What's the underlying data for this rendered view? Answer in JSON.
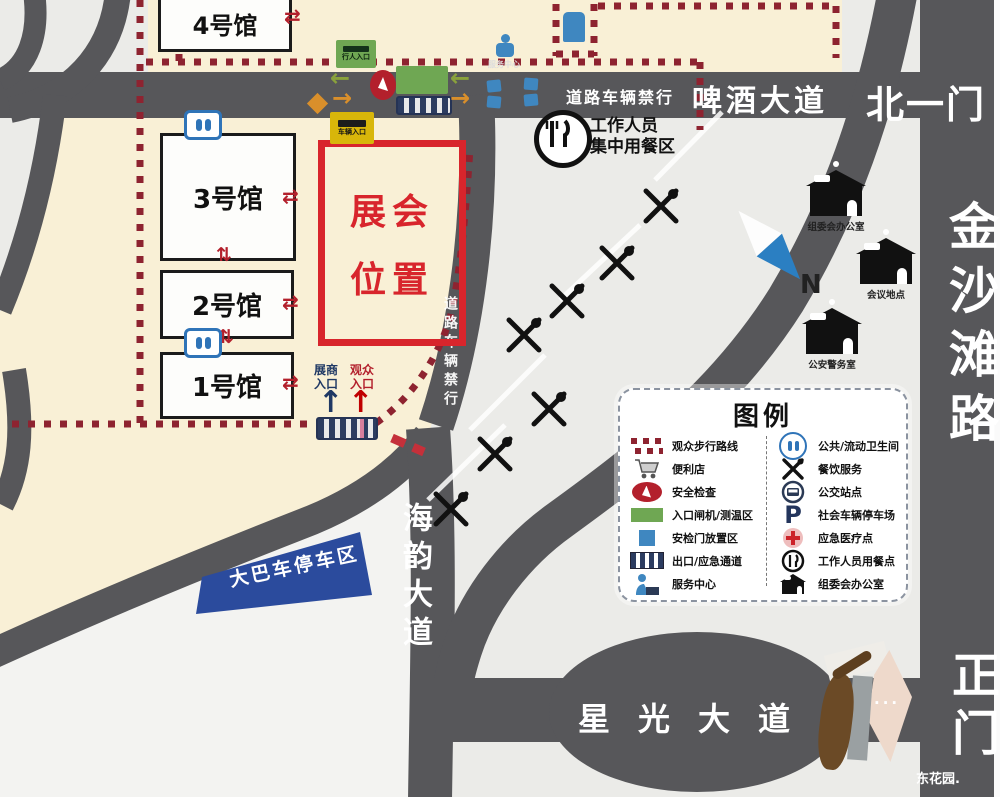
{
  "map": {
    "halls": [
      {
        "label": "4号馆"
      },
      {
        "label": "3号馆"
      },
      {
        "label": "2号馆"
      },
      {
        "label": "1号馆"
      }
    ],
    "exhibition_box": {
      "line1": "展会",
      "line2": "位置"
    },
    "roads": {
      "beer_avenue": "啤酒大道",
      "no_vehicles_h": "道路车辆禁行",
      "no_vehicles_v": "道路车辆禁行",
      "haiyun_avenue": "海韵大道",
      "starlight_avenue": "星光大道",
      "jinshatan_road": "金沙滩路"
    },
    "gates": {
      "north_gate_1": "北一门",
      "main_gate": "正门"
    },
    "bus_parking_label": "大巴车停车区",
    "staff_dining": {
      "line1": "工作人员",
      "line2": "集中用餐区"
    },
    "entrances": {
      "exhibitor": {
        "line1": "展商",
        "line2": "入口"
      },
      "visitor": {
        "line1": "观众",
        "line2": "入口"
      }
    },
    "small_signs": {
      "green_sign": "行人入口",
      "yellow_sign": "车辆入口",
      "service_point": "服务中心"
    },
    "buildings": [
      {
        "label": "组委会办公室"
      },
      {
        "label": "会议地点"
      },
      {
        "label": "公安警务室"
      }
    ],
    "compass_n": "N",
    "watermark": "东花园."
  },
  "legend": {
    "title": "图例",
    "left": [
      {
        "icon": "dotted-route-icon",
        "label": "观众步行路线"
      },
      {
        "icon": "cart-icon",
        "label": "便利店"
      },
      {
        "icon": "security-check-icon",
        "label": "安全检查"
      },
      {
        "icon": "entry-gate-icon",
        "label": "入口闸机/测温区"
      },
      {
        "icon": "security-door-icon",
        "label": "安检门放置区"
      },
      {
        "icon": "exit-stripes-icon",
        "label": "出口/应急通道"
      },
      {
        "icon": "service-desk-icon",
        "label": "服务中心"
      }
    ],
    "right": [
      {
        "icon": "restroom-icon",
        "label": "公共/流动卫生间"
      },
      {
        "icon": "dining-x-icon",
        "label": "餐饮服务"
      },
      {
        "icon": "bus-stop-icon",
        "label": "公交站点"
      },
      {
        "icon": "parking-icon",
        "label": "社会车辆停车场"
      },
      {
        "icon": "medical-icon",
        "label": "应急医疗点"
      },
      {
        "icon": "staff-dining-icon",
        "label": "工作人员用餐点"
      },
      {
        "icon": "office-icon",
        "label": "组委会办公室"
      }
    ]
  },
  "icons": {
    "arrow_left": "←",
    "arrow_right": "→",
    "arrow_up": "↑",
    "transfer_h": "⇄",
    "transfer_v": "⇅",
    "dots": "···",
    "parking_letter": "P"
  }
}
